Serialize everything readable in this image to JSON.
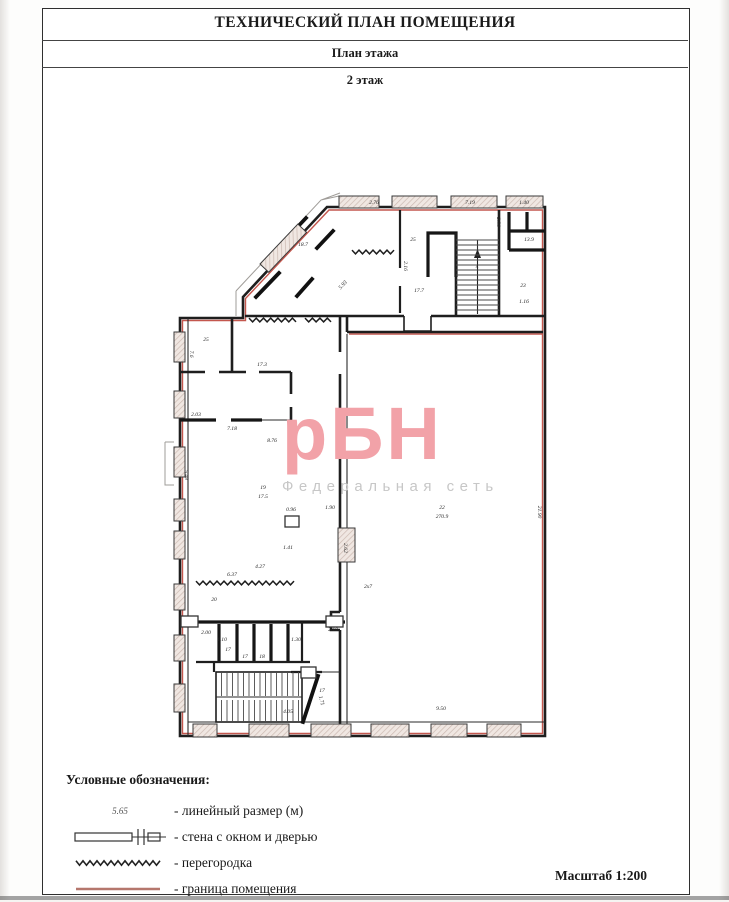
{
  "page": {
    "title": "ТЕХНИЧЕСКИЙ ПЛАН ПОМЕЩЕНИЯ",
    "subtitle": "План этажа",
    "floor_label": "2 этаж",
    "scale_label": "Масштаб 1:200"
  },
  "watermark": {
    "text": "рБН",
    "subtext": "Федеральная сеть",
    "color": "#f2a2a8",
    "subtext_color": "#c7c7c7"
  },
  "legend": {
    "heading": "Условные обозначения:",
    "items": [
      {
        "symbol": "linear-dimension",
        "sample": "5.65",
        "label": "- линейный размер (м)"
      },
      {
        "symbol": "wall-window-door",
        "sample": "",
        "label": "- стена с окном и дверью"
      },
      {
        "symbol": "partition",
        "sample": "",
        "label": "- перегородка"
      },
      {
        "symbol": "boundary",
        "sample": "",
        "label": "- граница помещения"
      }
    ]
  },
  "colors": {
    "wall": "#1e1e1e",
    "boundary_red": "#c4574e",
    "legend_boundary_red": "#b5776d",
    "window_fill": "#f0e7e2",
    "window_hatch": "#cbb9b1",
    "watermark_pink": "#f2a2a8"
  },
  "plan": {
    "windows": [
      {
        "x": 174,
        "y": 332,
        "w": 11,
        "h": 30
      },
      {
        "x": 174,
        "y": 391,
        "w": 11,
        "h": 27
      },
      {
        "x": 174,
        "y": 447,
        "w": 11,
        "h": 30
      },
      {
        "x": 174,
        "y": 499,
        "w": 11,
        "h": 22
      },
      {
        "x": 174,
        "y": 531,
        "w": 11,
        "h": 28
      },
      {
        "x": 174,
        "y": 584,
        "w": 11,
        "h": 26
      },
      {
        "x": 174,
        "y": 635,
        "w": 11,
        "h": 26
      },
      {
        "x": 174,
        "y": 684,
        "w": 11,
        "h": 28
      },
      {
        "x": 339,
        "y": 196,
        "w": 40,
        "h": 12
      },
      {
        "x": 392,
        "y": 196,
        "w": 45,
        "h": 12
      },
      {
        "x": 451,
        "y": 196,
        "w": 46,
        "h": 12
      },
      {
        "x": 506,
        "y": 196,
        "w": 37,
        "h": 12
      },
      {
        "x": 193,
        "y": 724,
        "w": 24,
        "h": 13
      },
      {
        "x": 249,
        "y": 724,
        "w": 40,
        "h": 13
      },
      {
        "x": 311,
        "y": 724,
        "w": 40,
        "h": 13
      },
      {
        "x": 371,
        "y": 724,
        "w": 38,
        "h": 13
      },
      {
        "x": 431,
        "y": 724,
        "w": 36,
        "h": 13
      },
      {
        "x": 487,
        "y": 724,
        "w": 34,
        "h": 13
      },
      {
        "x": 260,
        "y": 264,
        "w": 55,
        "h": 12,
        "r": -46.5
      },
      {
        "x": 338,
        "y": 528,
        "w": 17,
        "h": 34
      }
    ],
    "partitions": [
      {
        "x1": 249,
        "y1": 320,
        "x2": 296,
        "y2": 320
      },
      {
        "x1": 305,
        "y1": 320,
        "x2": 331,
        "y2": 320
      },
      {
        "x1": 352,
        "y1": 252,
        "x2": 394,
        "y2": 252
      },
      {
        "x1": 196,
        "y1": 583,
        "x2": 294,
        "y2": 583
      }
    ],
    "stairs": [
      {
        "x": 456,
        "y": 240,
        "w": 43,
        "h": 74,
        "dir": "h",
        "step": 5
      },
      {
        "x": 216,
        "y": 672,
        "w": 86,
        "h": 24,
        "dir": "v",
        "step": 5.5
      },
      {
        "x": 216,
        "y": 700,
        "w": 86,
        "h": 22,
        "dir": "v",
        "step": 5.5
      }
    ],
    "labels": [
      {
        "t": "2.76",
        "x": 374,
        "y": 204
      },
      {
        "t": "7.19",
        "x": 470,
        "y": 204
      },
      {
        "t": "1.40",
        "x": 524,
        "y": 204
      },
      {
        "t": "18.7",
        "x": 303,
        "y": 246
      },
      {
        "t": "5.93",
        "x": 344,
        "y": 286,
        "r": -47
      },
      {
        "t": "25",
        "x": 413,
        "y": 241
      },
      {
        "t": "2.16",
        "x": 404,
        "y": 266,
        "r": 90
      },
      {
        "t": "17.7",
        "x": 419,
        "y": 292
      },
      {
        "t": "4",
        "x": 477,
        "y": 268
      },
      {
        "t": "13.9",
        "x": 529,
        "y": 241
      },
      {
        "t": "23",
        "x": 523,
        "y": 287
      },
      {
        "t": "1.16",
        "x": 524,
        "y": 303
      },
      {
        "t": "2.56",
        "x": 497,
        "y": 222,
        "r": 90
      },
      {
        "t": "25",
        "x": 206,
        "y": 341
      },
      {
        "t": "7.6",
        "x": 190,
        "y": 354,
        "r": 90
      },
      {
        "t": "17.3",
        "x": 262,
        "y": 366
      },
      {
        "t": "2.03",
        "x": 196,
        "y": 416
      },
      {
        "t": "7.18",
        "x": 232,
        "y": 430
      },
      {
        "t": "8.76",
        "x": 272,
        "y": 442
      },
      {
        "t": "5.48",
        "x": 185,
        "y": 475,
        "r": 90
      },
      {
        "t": "19",
        "x": 263,
        "y": 489
      },
      {
        "t": "17.5",
        "x": 263,
        "y": 498
      },
      {
        "t": "0.96",
        "x": 291,
        "y": 511
      },
      {
        "t": "1.90",
        "x": 330,
        "y": 509
      },
      {
        "t": "2.62",
        "x": 344,
        "y": 548,
        "r": 90
      },
      {
        "t": "1.41",
        "x": 288,
        "y": 549
      },
      {
        "t": "6.37",
        "x": 232,
        "y": 576
      },
      {
        "t": "4.27",
        "x": 260,
        "y": 568
      },
      {
        "t": "20",
        "x": 214,
        "y": 601
      },
      {
        "t": "2x7",
        "x": 368,
        "y": 588
      },
      {
        "t": "17",
        "x": 228,
        "y": 651
      },
      {
        "t": "17",
        "x": 245,
        "y": 658
      },
      {
        "t": "18",
        "x": 262,
        "y": 658
      },
      {
        "t": "1.10",
        "x": 222,
        "y": 641
      },
      {
        "t": "2.00",
        "x": 206,
        "y": 634
      },
      {
        "t": "2.10",
        "x": 333,
        "y": 631
      },
      {
        "t": "1.30",
        "x": 296,
        "y": 641
      },
      {
        "t": "1.71",
        "x": 320,
        "y": 701,
        "r": 75
      },
      {
        "t": "4.05",
        "x": 288,
        "y": 713
      },
      {
        "t": "17",
        "x": 322,
        "y": 692
      },
      {
        "t": "22",
        "x": 442,
        "y": 509
      },
      {
        "t": "270.9",
        "x": 442,
        "y": 518
      },
      {
        "t": "21.90",
        "x": 538,
        "y": 512,
        "r": 90
      },
      {
        "t": "9.50",
        "x": 441,
        "y": 710
      }
    ]
  }
}
